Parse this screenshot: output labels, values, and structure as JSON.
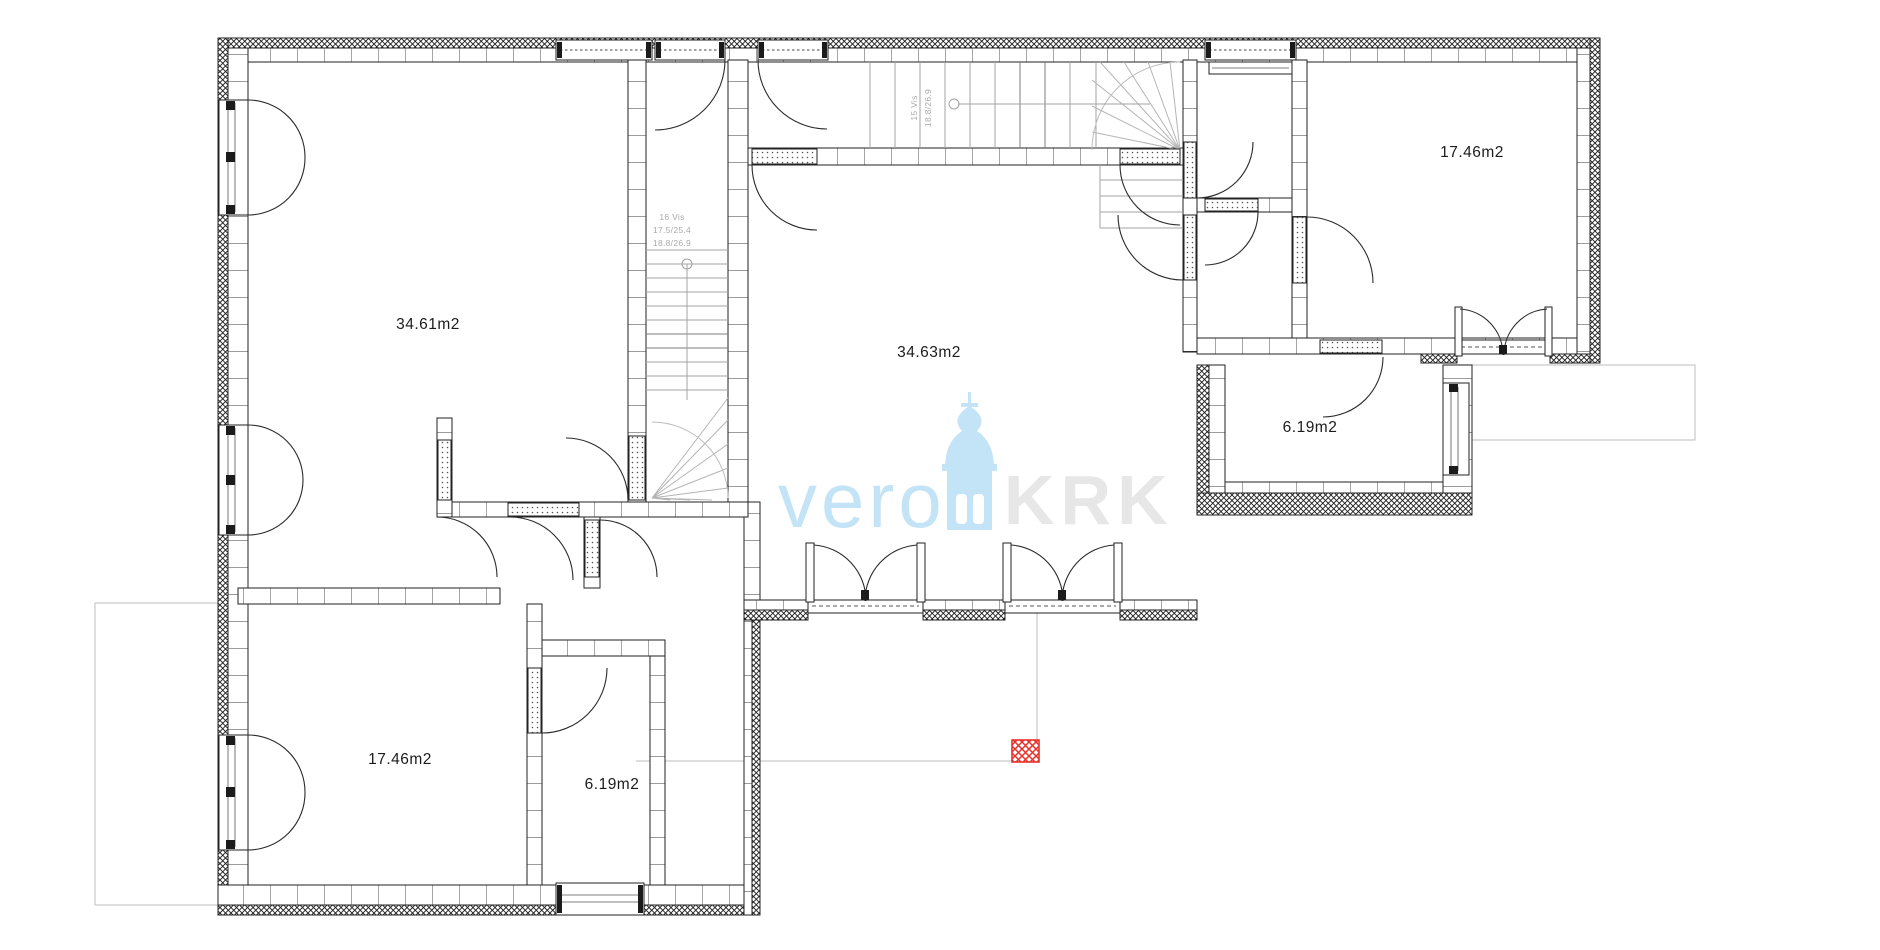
{
  "plan": {
    "title": "floor-plan",
    "rooms": [
      {
        "id": "room-a",
        "label": "34.61m2"
      },
      {
        "id": "room-b",
        "label": "34.63m2"
      },
      {
        "id": "room-c",
        "label": "17.46m2"
      },
      {
        "id": "room-d",
        "label": "6.19m2"
      },
      {
        "id": "room-e",
        "label": "17.46m2"
      },
      {
        "id": "room-f",
        "label": "6.19m2"
      }
    ],
    "stairs": {
      "left": {
        "line1": "16 Vis",
        "line2": "17.5/25.4",
        "line3": "18.8/26.9"
      },
      "top": {
        "line1": "15 Vis",
        "line2": "18.8/26.9"
      }
    }
  },
  "watermark": {
    "word_left": "vero",
    "word_right": "KRK",
    "blue_color": "#c3e3f7",
    "gray_color": "#e7e7e7"
  },
  "marker": {
    "color": "#e8312a"
  },
  "colors": {
    "wall_line": "#222222",
    "stair_line": "#a3a3a3",
    "terrace_line": "#c9c9c9"
  }
}
